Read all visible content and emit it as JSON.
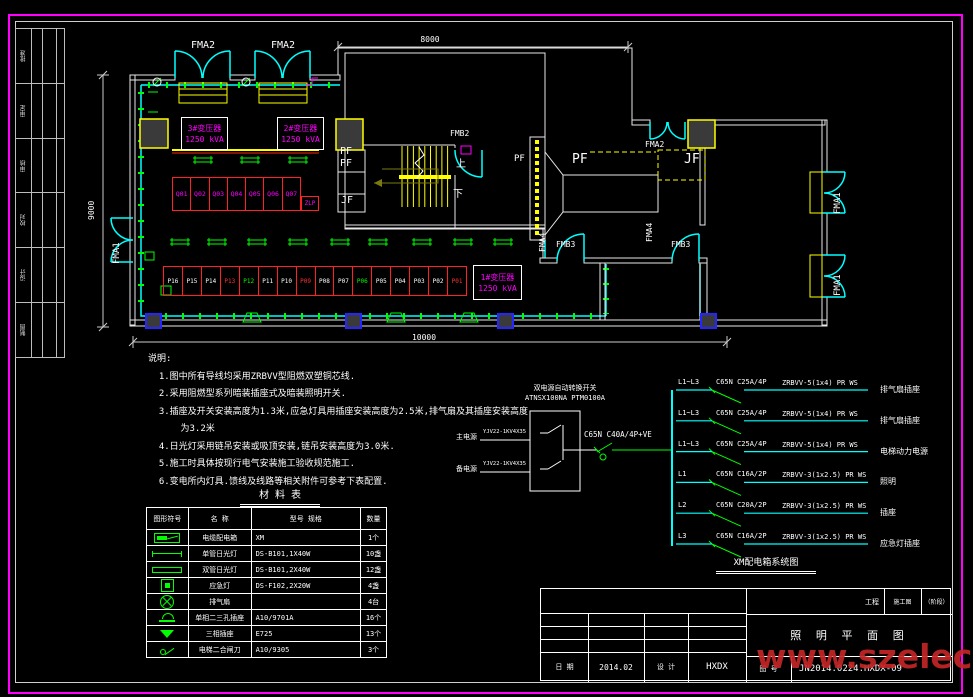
{
  "frame": {
    "strip_labels": [
      "批准",
      "审定",
      "审核",
      "校对",
      "设计",
      "制图"
    ]
  },
  "dimensions": {
    "top": "8000",
    "left": "9000",
    "bottom": "10000"
  },
  "plan": {
    "door_labels": {
      "fma2_a": "FMA2",
      "fma2_b": "FMA2",
      "fma2_c": "FMA2",
      "fma1_left": "FMA1",
      "fma1_r1": "FMA1",
      "fma1_r2": "FMA1",
      "fma4_a": "FMA4",
      "fma4_b": "FMA4",
      "fmb2": "FMB2",
      "fmb3_a": "FMB3",
      "fmb3_b": "FMB3"
    },
    "room_labels": {
      "pf1": "PF",
      "pf2": "PF",
      "pf3": "PF",
      "pf4": "PF",
      "jf1": "JF",
      "jf2": "JF",
      "up": "上",
      "down": "下"
    },
    "transformers": [
      {
        "line1": "3#变压器",
        "line2": "1250 kVA"
      },
      {
        "line1": "2#变压器",
        "line2": "1250 kVA"
      },
      {
        "line1": "1#变压器",
        "line2": "1250 kVA"
      }
    ],
    "zlp": "ZLP",
    "q_panels": [
      "Q01",
      "Q02",
      "Q03",
      "Q04",
      "Q05",
      "Q06",
      "Q07"
    ],
    "p_panels": [
      {
        "label": "P16",
        "color": "#ffffff"
      },
      {
        "label": "P15",
        "color": "#ffffff"
      },
      {
        "label": "P14",
        "color": "#ffffff"
      },
      {
        "label": "P13",
        "color": "#ff3333"
      },
      {
        "label": "P12",
        "color": "#00ff00"
      },
      {
        "label": "P11",
        "color": "#ffffff"
      },
      {
        "label": "P10",
        "color": "#ffffff"
      },
      {
        "label": "P09",
        "color": "#ff3333"
      },
      {
        "label": "P08",
        "color": "#ffffff"
      },
      {
        "label": "P07",
        "color": "#ffffff"
      },
      {
        "label": "P06",
        "color": "#00ff00"
      },
      {
        "label": "P05",
        "color": "#ffffff"
      },
      {
        "label": "P04",
        "color": "#ffffff"
      },
      {
        "label": "P03",
        "color": "#ffffff"
      },
      {
        "label": "P02",
        "color": "#ffffff"
      },
      {
        "label": "P01",
        "color": "#ff3333"
      }
    ]
  },
  "notes": {
    "lines": [
      "说明:",
      "  1.图中所有导线均采用ZRBVV型阻燃双塑铜芯线.",
      "  2.采用阻燃型系列暗装插座式及暗装照明开关.",
      "  3.插座及开关安装高度为1.3米,应急灯具用插座安装高度为2.5米,排气扇及其插座安装高度",
      "      为3.2米",
      "  4.日光灯采用链吊安装或吸顶安装,链吊安装高度为3.0米.",
      "  5.施工时具体按现行电气安装施工验收规范施工.",
      "  6.变电所内灯具.馈线及线路等相关附件可参考下表配置."
    ]
  },
  "material_table": {
    "title": "材 料 表",
    "headers": [
      "图形符号",
      "名  称",
      "型号  规格",
      "数量"
    ],
    "rows": [
      {
        "symbol": "sym-distbox",
        "name": "电缆配电箱",
        "spec": "XM",
        "qty": "1个"
      },
      {
        "symbol": "sym-1lamp",
        "name": "单管日光灯",
        "spec": "DS-B101,1X40W",
        "qty": "10盏"
      },
      {
        "symbol": "sym-2lamp",
        "name": "双管日光灯",
        "spec": "DS-B101,2X40W",
        "qty": "12盏"
      },
      {
        "symbol": "sym-emerg",
        "name": "应急灯",
        "spec": "DS-F102,2X20W",
        "qty": "4盏"
      },
      {
        "symbol": "sym-fan",
        "name": "排气扇",
        "spec": "",
        "qty": "4台"
      },
      {
        "symbol": "sym-socket23",
        "name": "单相二三孔插座",
        "spec": "A10/9701A",
        "qty": "16个"
      },
      {
        "symbol": "sym-socket3",
        "name": "三相插座",
        "spec": "E725",
        "qty": "13个"
      },
      {
        "symbol": "sym-knife",
        "name": "电梯二合闸刀",
        "spec": "A10/9305",
        "qty": "3个"
      }
    ]
  },
  "system_diagram": {
    "ats_name": "双电源自动转换开关",
    "ats_model": "ATNSX100NA PTM0100A",
    "inputs": [
      {
        "name": "主电源",
        "cable": "YJV22-1KV4X35"
      },
      {
        "name": "备电源",
        "cable": "YJV22-1KV4X35"
      }
    ],
    "main_breaker": "C65N C40A/4P+VE",
    "branches": [
      {
        "phase": "L1~L3",
        "breaker": "C65N C25A/4P",
        "cable": "ZRBVV-5(1x4) PR WS",
        "load": "排气扇插座"
      },
      {
        "phase": "L1~L3",
        "breaker": "C65N C25A/4P",
        "cable": "ZRBVV-5(1x4) PR WS",
        "load": "排气扇插座"
      },
      {
        "phase": "L1~L3",
        "breaker": "C65N C25A/4P",
        "cable": "ZRBVV-5(1x4) PR WS",
        "load": "电梯动力电源"
      },
      {
        "phase": "L1",
        "breaker": "C65N C16A/2P",
        "cable": "ZRBVV-3(1x2.5) PR WS",
        "load": "照明"
      },
      {
        "phase": "L2",
        "breaker": "C65N C20A/2P",
        "cable": "ZRBVV-3(1x2.5) PR WS",
        "load": "插座"
      },
      {
        "phase": "L3",
        "breaker": "C65N C16A/2P",
        "cable": "ZRBVV-3(1x2.5) PR WS",
        "load": "应急灯插座"
      }
    ],
    "caption": "XM配电箱系统图"
  },
  "title_block": {
    "project_label": "工程",
    "stage": "施工图",
    "stage_paren": "（阶段）",
    "drawing_title": "照 明 平 面 图",
    "date_label": "日 期",
    "date_value": "2014.02",
    "design_label": "设 计",
    "design_value": "HXDX",
    "number_label": "图 号",
    "number_value": "JN2014.0224.HXDX-09"
  },
  "watermark": "www.szelec.cc"
}
